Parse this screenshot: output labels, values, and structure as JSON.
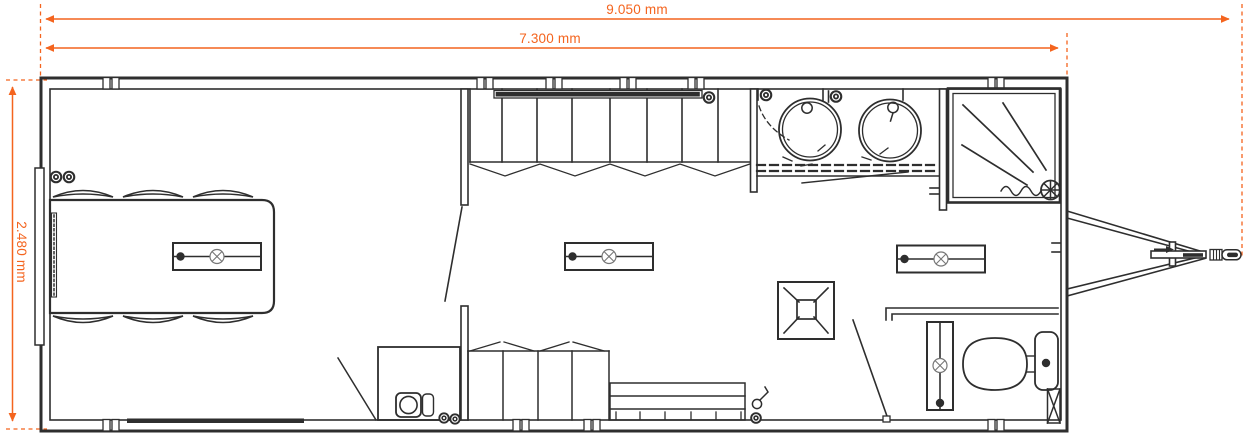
{
  "meta": {
    "drawing_type": "mobile-unit floor plan (top view)",
    "units": "mm"
  },
  "colors": {
    "line": "#2e2e2e",
    "dimension": "#F4641E",
    "background": "#ffffff",
    "lamp_symbol": "#777777"
  },
  "dimensions": {
    "total_length": "9.050 mm",
    "body_length": "7.300 mm",
    "width": "2.480 mm"
  },
  "fixtures": [
    "dining-table",
    "chairs-6",
    "wall-lights",
    "sliding-door-panel",
    "entrance-mat",
    "ceiling-light-bars",
    "wardrobe-with-hanging-rail",
    "folding-front",
    "washing-machine-cabinet",
    "lower-wardrobe",
    "bench-seat",
    "coat-hook",
    "roof-vent",
    "double-washbasin",
    "shower-cabin",
    "extractor-fan",
    "toilet-with-cistern",
    "vertical-light-bar",
    "vent-duct",
    "trailer-drawbar",
    "tow-coupling"
  ]
}
